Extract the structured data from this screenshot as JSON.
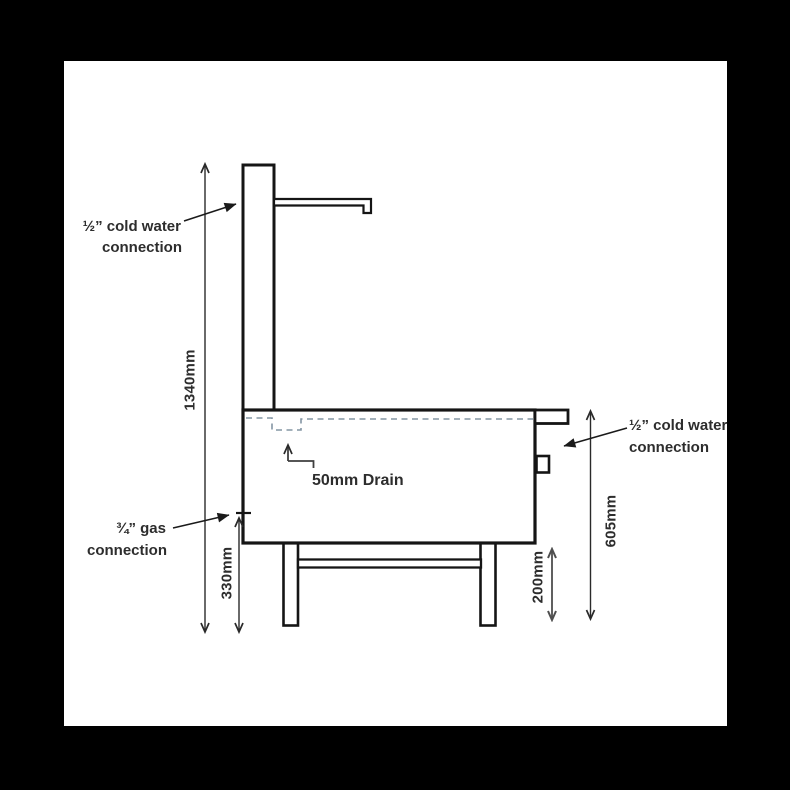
{
  "labels": {
    "top_water_1": "½” cold water",
    "top_water_2": "connection",
    "gas_1": "¾” gas",
    "gas_2": "connection",
    "right_water_1": "½” cold water",
    "right_water_2": "connection",
    "drain": "50mm Drain"
  },
  "dimensions": {
    "overall_height": "1340mm",
    "gas_connection_height": "330mm",
    "underframe_clearance": "200mm",
    "worktop_height": "605mm"
  },
  "colors": {
    "background": "#000000",
    "paper": "#ffffff",
    "outline": "#151515",
    "dimension_line": "#2a2a2a",
    "clearance_dim_line": "#4f4f4f",
    "hidden_waterline_dash": "#8495a3",
    "text": "#2d2d2d"
  }
}
